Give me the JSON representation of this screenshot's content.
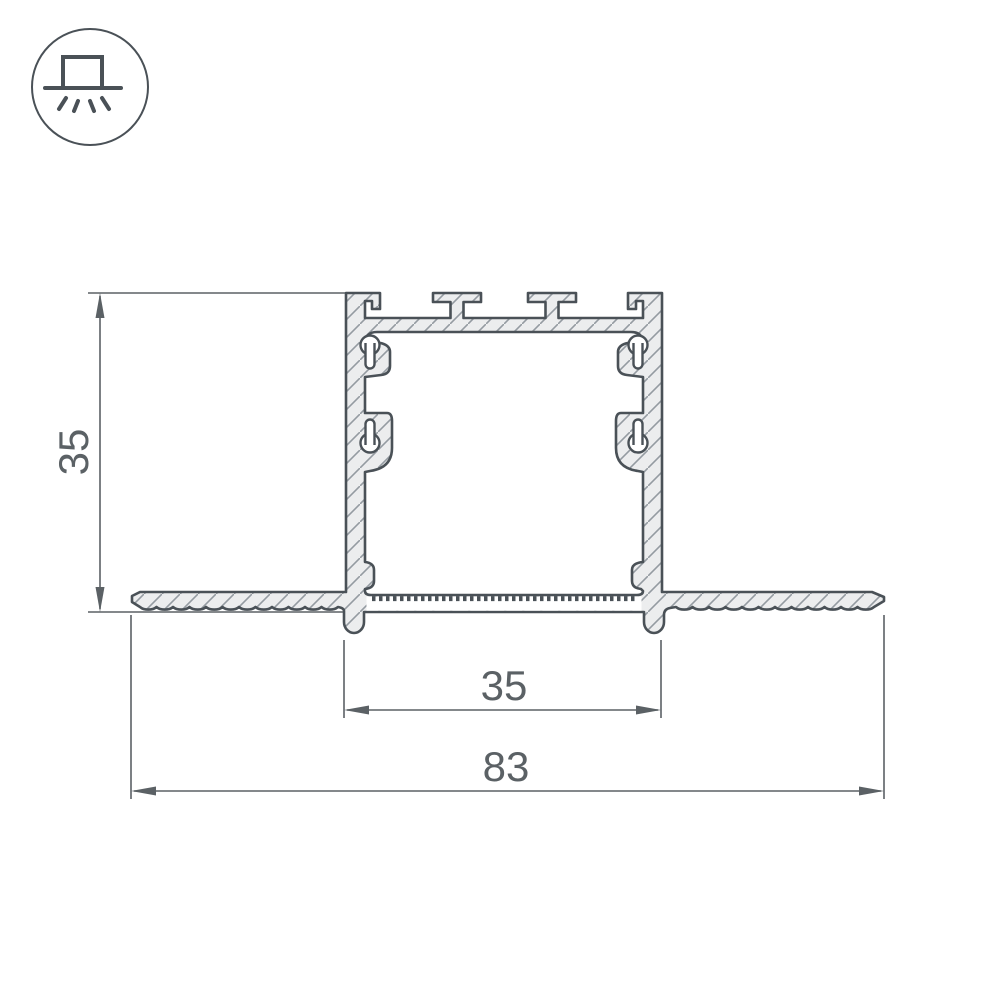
{
  "drawing": {
    "kind": "led-profile-recessed-cross-section",
    "icon": "recessed-luminaire-icon",
    "dimensions": {
      "height": "35",
      "inner_width": "35",
      "overall_width": "83"
    },
    "colors": {
      "outline": "#4A5157",
      "metal": "#ECEDEE",
      "hatch": "#949BA1",
      "dimension": "#5B6165",
      "background": "#FFFFFF"
    }
  }
}
